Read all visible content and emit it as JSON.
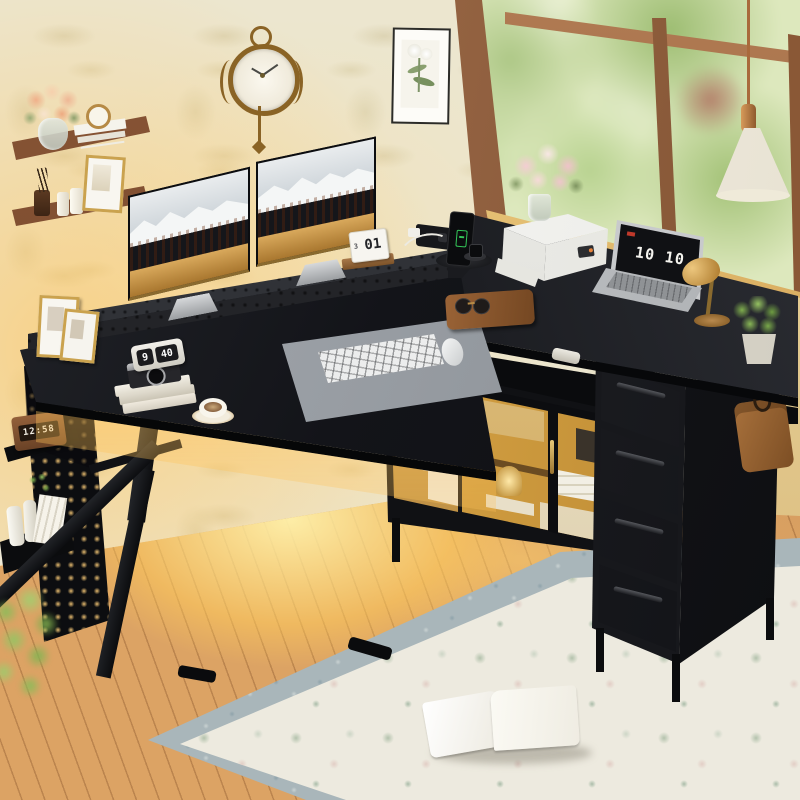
{
  "image": {
    "type": "product-lifestyle-photo",
    "subject": "Black L-shaped computer desk with perforated monitor riser, LED glass-door storage cabinet, 4 fabric drawers, pegboard side panel and K-shaped leg, staged in a sunlit room with floral wallpaper, garden window, wood floor and floral rug"
  },
  "displays": {
    "flip_clock_hour": "9",
    "flip_clock_minute": "40",
    "laptop_clock": "10 10",
    "led_clock": "12:58",
    "calendar_day": "01",
    "calendar_month": "3"
  },
  "colors": {
    "desk_black": "#121318",
    "desk_highlight": "#2b2d33",
    "wallpaper": "#ece6cf",
    "floor_wood": "#dca364",
    "floor_glow": "#ffd978",
    "led_amber": "#f0b44e",
    "window_foliage": "#dde8bd",
    "window_frame": "#9b6a4a",
    "shelf_wood": "#7b4b30",
    "brass": "#b68a45",
    "rug_field": "#ece9df",
    "rug_border": "#a9b6ba"
  },
  "wall_decor": {
    "clock": "ornate bronze wall clock with pendulum",
    "print": "framed botanical flower print",
    "shelf_top_items": [
      "peach bouquet in glass vase",
      "stack of white books",
      "gold alarm clock"
    ],
    "shelf_bottom_items": [
      "reed diffuser",
      "two white candles",
      "gold framed sketch"
    ]
  },
  "window": {
    "view": "green garden foliage",
    "pendant_lamp": "white pleated cone pendant with copper cap",
    "sill_flowers": "pink peonies in glass vase"
  },
  "desk": {
    "monitor_count": "2",
    "monitor_wallpaper": "snowy peaks over autumn forest",
    "riser": "perforated metal monitor shelf",
    "left_items": [
      "two gold photo frames",
      "flip clock",
      "retro camera",
      "book stack",
      "latte cup on brass saucer"
    ],
    "center_items": [
      "grey desk mat",
      "white keyboard",
      "white mouse"
    ],
    "corner_items": [
      "leather organizer with sunglasses",
      "flip calendar",
      "recessed power hub",
      "phone on charging stand",
      "smartwatch pad"
    ],
    "right_items": [
      "white printer",
      "laptop showing flip clock",
      "brass dome lamp",
      "potted plant",
      "white model decor"
    ]
  },
  "storage": {
    "cabinet": "LED-lit glass-door cabinet with storage boxes, speaker, gold trophy, retro camera and white speaker",
    "drawer_count": "4",
    "drawer_style": "black fabric drawers with metal bar handles",
    "side_hook_item": "brown leather bag on hook"
  },
  "side_panel": {
    "type": "pegboard with glowing holes",
    "shelf_items": [
      "wooden LED clock",
      "white bottles",
      "rolled papers",
      "green sprig"
    ]
  },
  "floor_items": {
    "rug": "cream floral area rug with grey-blue border",
    "book": "open white book on rug",
    "plant": "green foreground plant"
  }
}
